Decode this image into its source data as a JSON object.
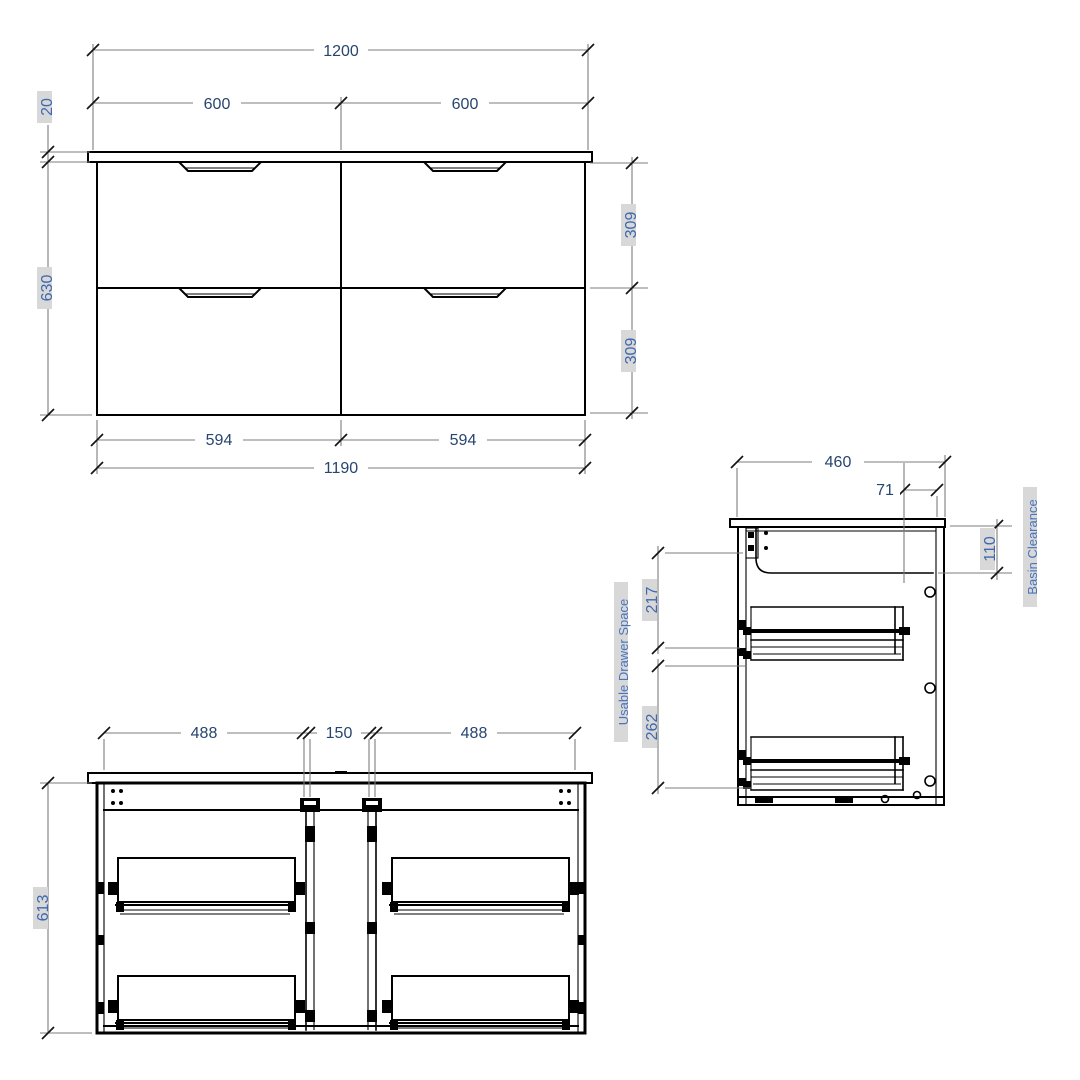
{
  "drawing": {
    "front_view": {
      "overall_top_width": "1200",
      "left_top_width": "600",
      "right_top_width": "600",
      "benchtop_thickness": "20",
      "cabinet_height": "630",
      "upper_drawer_height": "309",
      "lower_drawer_height": "309",
      "left_drawer_width": "594",
      "right_drawer_width": "594",
      "cabinet_width": "1190"
    },
    "side_view": {
      "depth": "460",
      "basin_offset": "71",
      "basin_clearance": "110",
      "upper_drawer_space": "217",
      "lower_drawer_space": "262",
      "usable_drawer_space_label": "Usable Drawer Space",
      "basin_clearance_label": "Basin Clearance"
    },
    "internal_view": {
      "left_drawer_space": "488",
      "center_gap": "150",
      "right_drawer_space": "488",
      "internal_height": "613"
    }
  },
  "colors": {
    "object_line": "#000000",
    "dimension_line": "#7d7d7d",
    "dimension_text": "#27456f",
    "rotated_dimension_text": "#3f68ad",
    "label_text": "#4a74bc",
    "label_background": "#d8d8d8",
    "background": "#ffffff"
  }
}
